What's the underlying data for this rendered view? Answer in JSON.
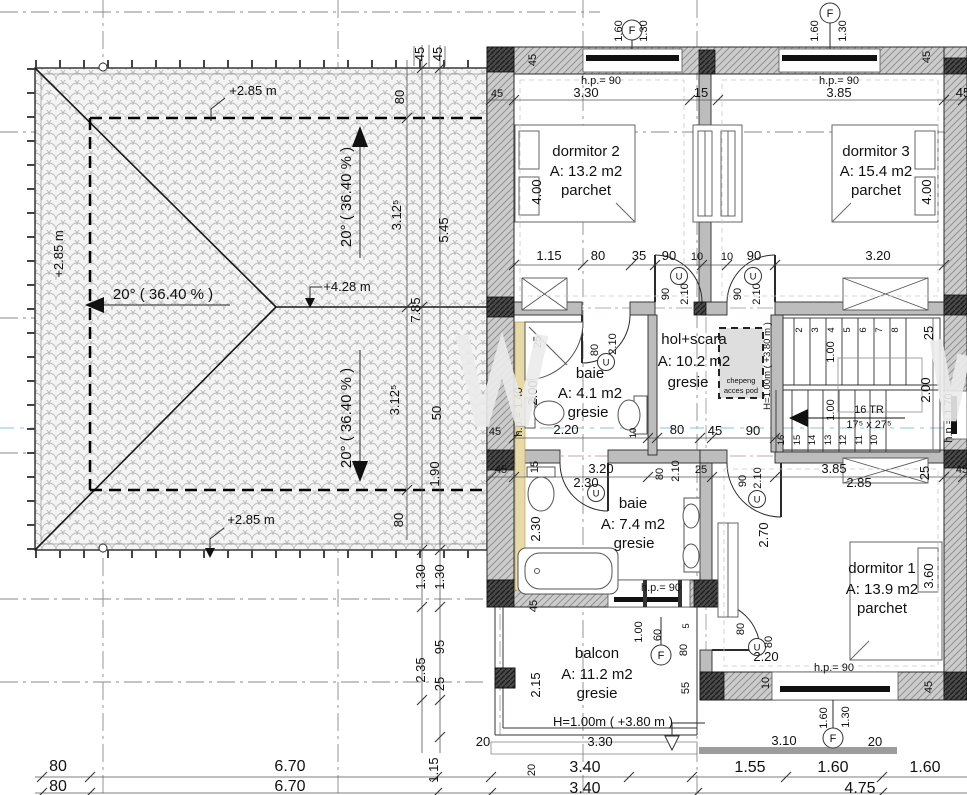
{
  "drawing": {
    "rooms": {
      "dormitor2": {
        "name": "dormitor 2",
        "area": "A: 13.2 m2",
        "finish": "parchet"
      },
      "dormitor3": {
        "name": "dormitor 3",
        "area": "A: 15.4 m2",
        "finish": "parchet"
      },
      "dormitor1": {
        "name": "dormitor 1",
        "area": "A: 13.9 m2",
        "finish": "parchet"
      },
      "hol": {
        "name": "hol+scara",
        "area": "A: 10.2 m2",
        "finish": "gresie"
      },
      "baie_mica": {
        "name": "baie",
        "area": "A: 4.1 m2",
        "finish": "gresie"
      },
      "baie_mare": {
        "name": "baie",
        "area": "A: 7.4 m2",
        "finish": "gresie"
      },
      "balcon": {
        "name": "balcon",
        "area": "A: 11.2 m2",
        "finish": "gresie"
      }
    },
    "roof": {
      "level_eave_top": "+2.85 m",
      "level_eave_left": "+2.85 m",
      "level_eave_bottom": "+2.85 m",
      "level_ridge": "+4.28 m",
      "slope_left": "20° ( 36.40 % )",
      "slope_up": "20° ( 36.40 % )",
      "slope_down": "20° ( 36.40 % )"
    },
    "stairs": {
      "steps_up": [
        "2",
        "3",
        "4",
        "5",
        "6",
        "7",
        "8"
      ],
      "steps_down": [
        "16",
        "15",
        "14",
        "13",
        "12",
        "11",
        "10"
      ],
      "treads": "16 TR",
      "tread_size": "17⁵ x 27⁵"
    },
    "attic_hatch": {
      "line1": "chepeng",
      "line2": "acces pod",
      "note": "H=1.00m ( +3.80 m )"
    },
    "balcony_note": "H=1.00m ( +3.80 m )",
    "markers": {
      "window": "F",
      "door": "U"
    },
    "sills": {
      "hp90": "h.p.= 90",
      "hp140": "h.p.= 1.40",
      "hp170": "h.p.= 1.70"
    },
    "dims": {
      "window_top": [
        "1.60",
        "1.30",
        "1.60",
        "1.30"
      ],
      "window_bottom": [
        "1.60",
        "1.30"
      ],
      "top_band": [
        "45",
        "3.30",
        "15",
        "3.85",
        "45",
        "45",
        "45"
      ],
      "bedroom_depth": [
        "4.00",
        "4.00"
      ],
      "mid_row": [
        "1.15",
        "80",
        "35",
        "90",
        "10",
        "10",
        "90",
        "3.20"
      ],
      "door_top": [
        "90",
        "2.10",
        "90",
        "2.10"
      ],
      "baie1": [
        "25",
        "80",
        "2.10",
        "2.00",
        "45",
        "2.20",
        "10"
      ],
      "hall_row": [
        "80",
        "45",
        "90"
      ],
      "stair_dims": [
        "1.00",
        "1.00",
        "2.00",
        "25"
      ],
      "low_row": [
        "45",
        "15",
        "3.20",
        "2.30",
        "80",
        "2.10",
        "25",
        "90",
        "2.10",
        "3.85",
        "2.85",
        "25",
        "45"
      ],
      "baie2_side": [
        "2.30",
        "45"
      ],
      "dorm1": [
        "2.70",
        "3.60",
        "55",
        "10",
        "45"
      ],
      "door_balcon_dorm1": [
        "80",
        "80",
        "2.20"
      ],
      "balcon": [
        "2.15",
        "1.00",
        "60",
        "5",
        "80",
        "20",
        "3.30",
        "20",
        "3.10",
        "20"
      ],
      "bottom_row1": [
        "80",
        "6.70",
        "3.40",
        "1.55",
        "1.60",
        "1.60"
      ],
      "bottom_row2": [
        "80",
        "6.70",
        "3.40",
        "4.75"
      ],
      "roof_col": [
        "45",
        "45",
        "80",
        "3.12⁵",
        "5.45",
        "7.85",
        "3.12⁵",
        "50",
        "1.90",
        "80"
      ],
      "left_col": [
        "1.30",
        "1.30",
        "95",
        "2.35",
        "25",
        "1.15"
      ]
    }
  }
}
